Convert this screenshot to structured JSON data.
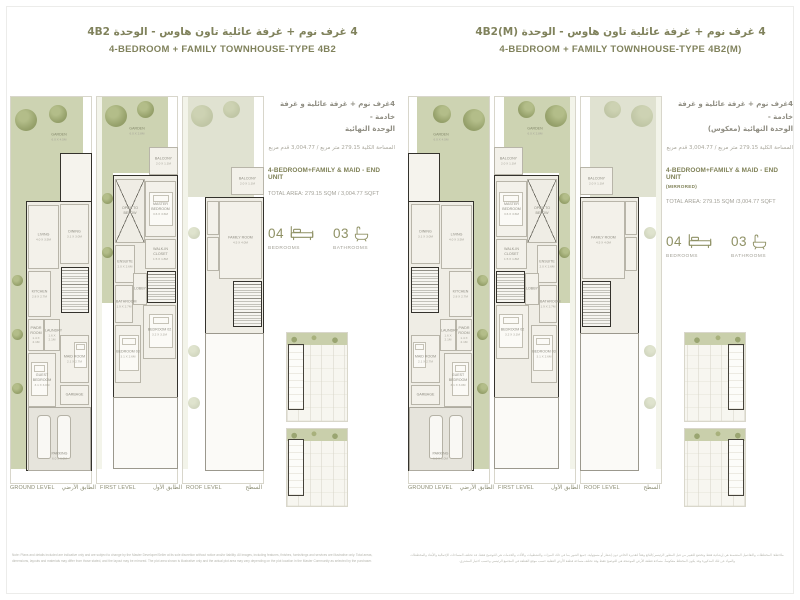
{
  "pages": {
    "left": {
      "title_ar": "4 غرف نوم + غرفة عائلية تاون هاوس - الوحدة 4B2",
      "title_en": "4-BEDROOM + FAMILY TOWNHOUSE-TYPE 4B2",
      "info": {
        "ar_line1": "4غرف نوم + غرفة عائلية و غرفة خادمة -",
        "ar_line2": "الوحدة النهائية",
        "ar_area": "المساحة الكلية 279.15 متر مربع / 3,004.77 قدم مربع",
        "en_heading": "4-BEDROOM+FAMILY & MAID - END UNIT",
        "en_area": "TOTAL AREA: 279.15 SQM / 3,004.77 SQFT"
      },
      "disclaimer": "Note: Plans and details included are indicative only and are subject to change by the Master Developer/Seller at its sole discretion without notice and/or liability. All images, including features, finishes, furnishings and services are illustrative only. Total areas, dimensions, layouts and materials may differ from those stated, and the layout may be mirrored. The plot area shown is illustrative only and the actual plot area may vary depending on the plot location in the Master Community as selected by the purchaser."
    },
    "right": {
      "title_ar": "4 غرف نوم + غرفة عائلية تاون هاوس - الوحدة 4B2(M)",
      "title_en": "4-BEDROOM + FAMILY TOWNHOUSE-TYPE 4B2(M)",
      "info": {
        "ar_line1": "4غرف نوم + غرفة عائلية و غرفة خادمة -",
        "ar_line2": "الوحدة النهائية (معكوس)",
        "ar_area": "المساحة الكلية 279.15 متر مربع / 3,004.77 قدم مربع",
        "en_heading": "4-BEDROOM+FAMILY & MAID - END UNIT",
        "en_note": "(MIRRORED)",
        "en_area": "TOTAL AREA: 279.15 SQM /3,004.77 SQFT"
      },
      "disclaimer": "ملاحظة: المخططات والتفاصيل المتضمنة هي إرشادية فقط وتخضع للتغيير من قبل المطور الرئيسي/البائع وفقاً لتقديره الخاص دون إشعار أو مسؤولية. جميع الصور بما في ذلك الميزات والتشطيبات والأثاث والخدمات هي للتوضيح فقط. قد تختلف المساحات الإجمالية والأبعاد والمخططات والمواد عن تلك المذكورة وقد يكون المخطط معكوساً. مساحة قطعة الأرض الموضحة هي للتوضيح فقط وقد تختلف مساحة قطعة الأرض الفعلية حسب موقع القطعة في المجتمع الرئيسي وحسب اختيار المشتري."
    }
  },
  "stats": {
    "bedrooms_count": "04",
    "bedrooms_label": "BEDROOMS",
    "bathrooms_count": "03",
    "bathrooms_label": "BATHROOMS"
  },
  "levels": [
    {
      "en": "GROUND LEVEL",
      "ar": "الطابق الأرضي"
    },
    {
      "en": "FIRST LEVEL",
      "ar": "الطابق الأول"
    },
    {
      "en": "ROOF LEVEL",
      "ar": "السطح"
    }
  ],
  "rooms": {
    "ground": {
      "garden": {
        "n": "GARDEN",
        "d": "6.0 X 4.5M"
      },
      "living": {
        "n": "LIVING",
        "d": "4.0 X 3.5M"
      },
      "dining": {
        "n": "DINING",
        "d": "3.1 X 3.0M"
      },
      "kitchen": {
        "n": "KITCHEN",
        "d": "2.8 X 2.7M"
      },
      "pwdr": {
        "n": "PWDR ROOM",
        "d": "1.4 X 2.1M"
      },
      "laundry": {
        "n": "LAUNDRY",
        "d": "1.6 X 2.1M"
      },
      "guest": {
        "n": "GUEST BEDROOM",
        "d": "3.1 X 3.0M"
      },
      "maid": {
        "n": "MAID ROOM",
        "d": "2.1 X 2.7M"
      },
      "garbage": {
        "n": "GARBAGE",
        "d": ""
      },
      "parking": {
        "n": "PARKING",
        "d": "6.0 X 6.0M"
      }
    },
    "first": {
      "garden": {
        "n": "GARDEN",
        "d": "6.0 X 2.8M"
      },
      "balcony": {
        "n": "BALCONY",
        "d": "2.0 X 1.1M"
      },
      "master": {
        "n": "MASTER BEDROOM",
        "d": "3.6 X 3.6M"
      },
      "void": {
        "n": "OPEN TO BELOW",
        "d": ""
      },
      "ensuite": {
        "n": "ENSUITE",
        "d": "2.0 X 2.6M"
      },
      "wic": {
        "n": "WALK-IN CLOSET",
        "d": "1.5 X 1.8M"
      },
      "lobby": {
        "n": "LOBBY",
        "d": ""
      },
      "bath": {
        "n": "BATHROOM",
        "d": "1.9 X 2.7M"
      },
      "bed3": {
        "n": "BEDROOM 03",
        "d": "3.1 X 2.6M"
      },
      "bed2": {
        "n": "BEDROOM 02",
        "d": "3.2 X 3.1M"
      }
    },
    "roof": {
      "balcony": {
        "n": "BALCONY",
        "d": "2.0 X 1.1M"
      },
      "family": {
        "n": "FAMILY ROOM",
        "d": "4.5 X 4.0M"
      }
    }
  }
}
